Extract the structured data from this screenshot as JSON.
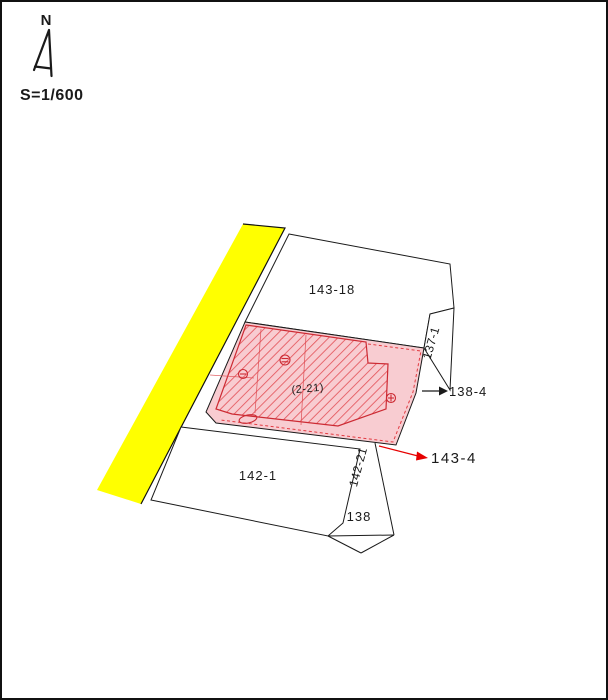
{
  "page": {
    "north_label": "N",
    "scale_label": "S=1/600"
  },
  "parcels": {
    "p143_18": {
      "label": "143-18"
    },
    "p142_1": {
      "label": "142-1"
    },
    "p138": {
      "label": "138"
    },
    "p137_1": {
      "label": "137-1"
    },
    "p142_21": {
      "label": "142-21"
    }
  },
  "subject": {
    "building_label": "(2-21)"
  },
  "callouts": {
    "black": {
      "label": "138-4"
    },
    "red": {
      "label": "143-4"
    }
  },
  "colors": {
    "road_yellow": "#ffff00",
    "parcel_fill": "#ffffff",
    "pink_fill": "#f8ccd1",
    "hatch_line": "#e4555c",
    "hatch_outline": "#cc2a33",
    "red_accent": "#e60000",
    "red_dash": "#e23b42",
    "line_black": "#1a1a1a"
  }
}
